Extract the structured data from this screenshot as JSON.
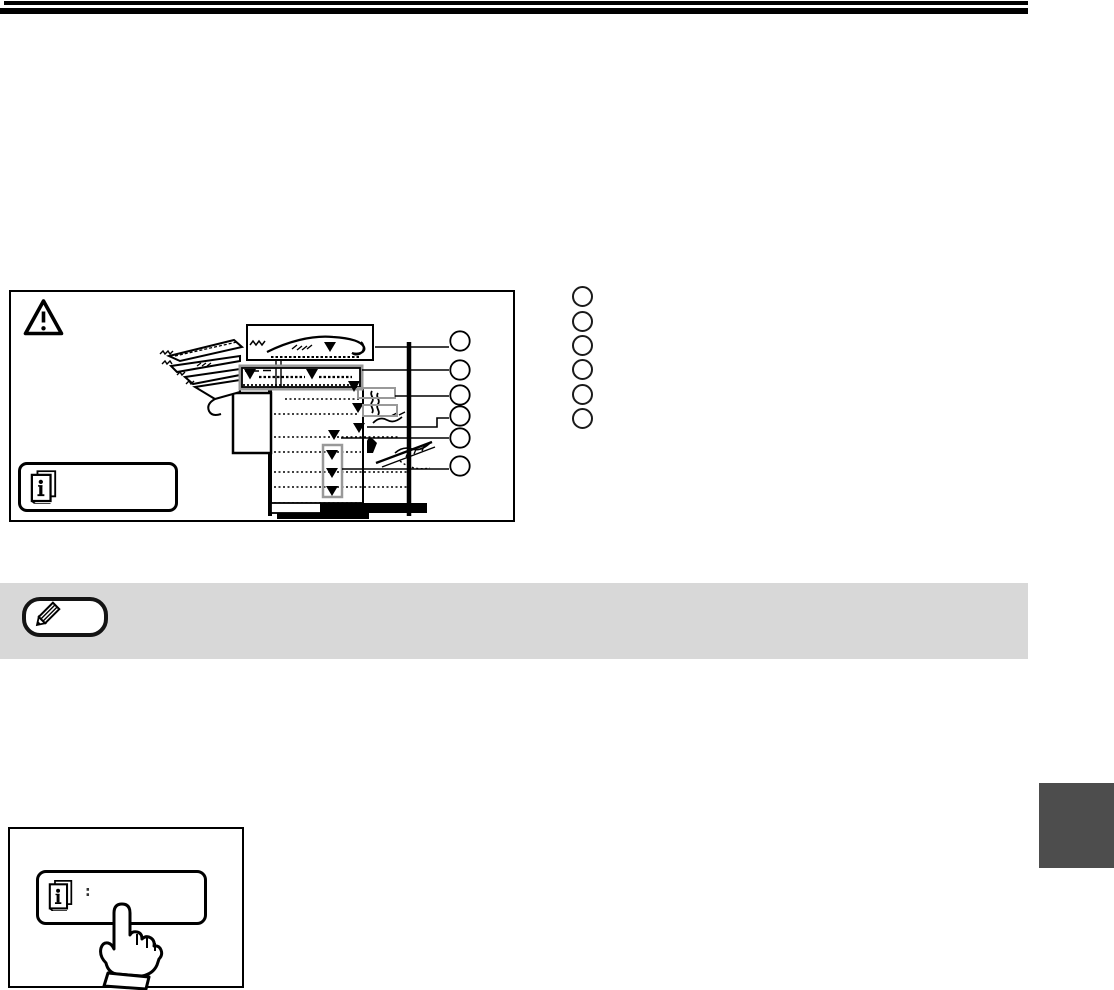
{
  "colors": {
    "ink": "#000000",
    "paper": "#ffffff",
    "band": "#d8d8d8",
    "tab": "#4d4d4d",
    "gray": "#999999"
  },
  "header": {
    "rule_count": 2
  },
  "figure": {
    "icons": {
      "warning": "warning-triangle-icon",
      "info_key": "info-book-icon"
    },
    "callout_arrow_count": 12,
    "callout_circle_count": 6,
    "legend_circle_count": 6
  },
  "note": {
    "icon": "pencil-icon"
  },
  "bottom_figure": {
    "icons": {
      "info_key": "info-book-icon",
      "hand": "pointing-hand-icon"
    },
    "colon": ":"
  }
}
